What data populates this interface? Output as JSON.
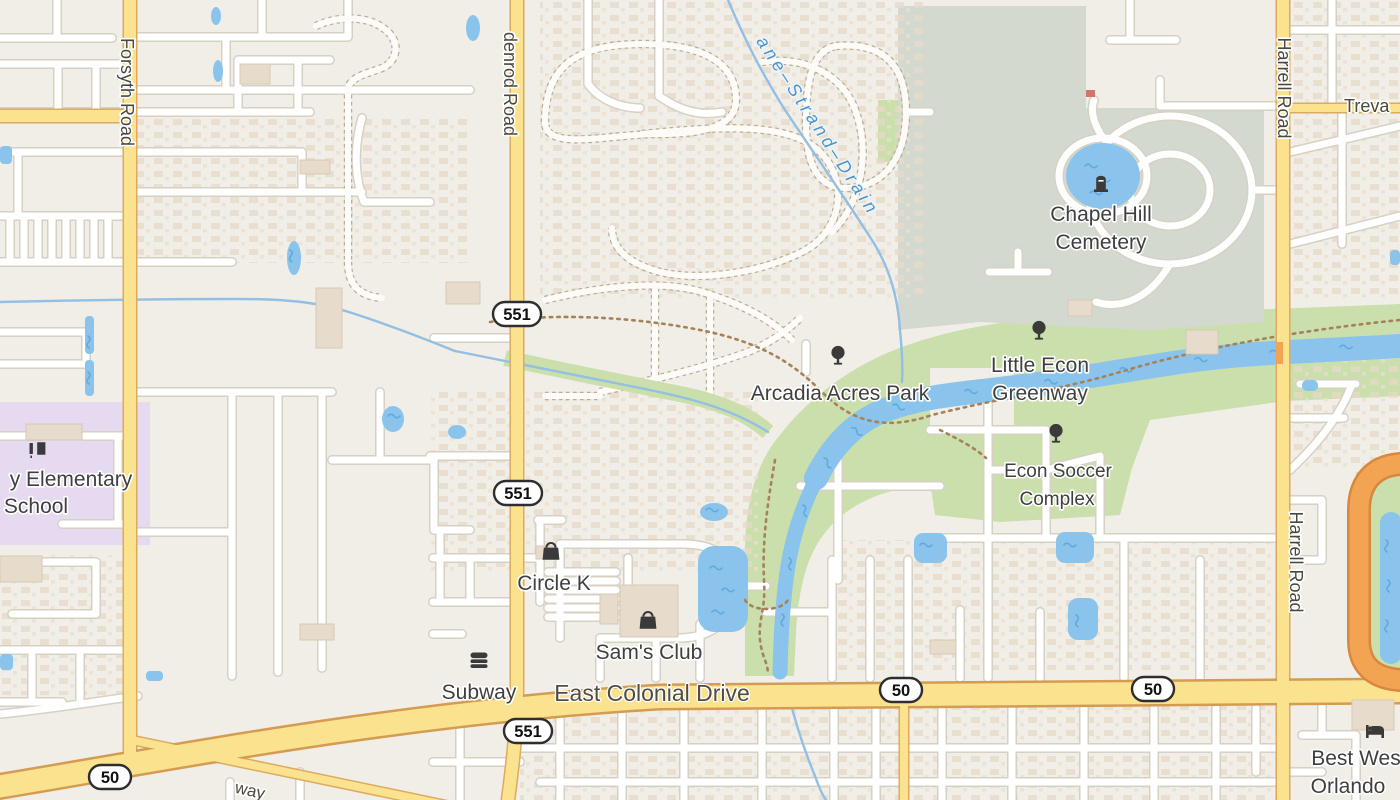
{
  "map_type": "openstreetmap-style street map",
  "colors": {
    "land": "#f1eee7",
    "residential_detail": "#e6dac8",
    "road_minor": "#ffffff",
    "road_minor_casing": "#d7d1c5",
    "road_secondary_fill": "#fbe28f",
    "road_secondary_casing": "#dcab60",
    "road_trunk_fill": "#f2a452",
    "water_fill": "#8ac4ec",
    "water_wave": "#64abdd",
    "park_green": "#cadfab",
    "cemetery_green": "#d4d9d0",
    "school_purple": "#e6daf1",
    "building_tan": "#e7dccb",
    "trail_brown": "#a5825a",
    "label_dark": "#3f3f3f",
    "label_water_blue": "#4f93c9"
  },
  "road_labels": {
    "forsyth": "Forsyth Road",
    "goldenrod_fragment": "denrod Road",
    "harrell": "Harrell Road",
    "trevarthon_fragment": "Treva",
    "east_colonial": "East Colonial Drive",
    "old_cheney_fragment": "way"
  },
  "route_shields": {
    "sr_551": "551",
    "sr_50": "50"
  },
  "water_labels": {
    "drain_fragment": "ane–Strand–Drain"
  },
  "places": {
    "chapel_hill_line1": "Chapel Hill",
    "chapel_hill_line2": "Cemetery",
    "little_econ_line1": "Little Econ",
    "little_econ_line2": "Greenway",
    "arcadia": "Arcadia Acres Park",
    "econ_soccer_line1": "Econ Soccer",
    "econ_soccer_line2": "Complex",
    "circle_k": "Circle K",
    "sams_club": "Sam's Club",
    "subway": "Subway",
    "best_western_line1": "Best Wes",
    "best_western_line2": "Orlando",
    "school_line1": "y Elementary",
    "school_line2": "School"
  },
  "icons": [
    "tree-icon",
    "grave-icon",
    "shopping-bag-icon",
    "fast-food-icon",
    "bed-icon",
    "school-icon"
  ]
}
